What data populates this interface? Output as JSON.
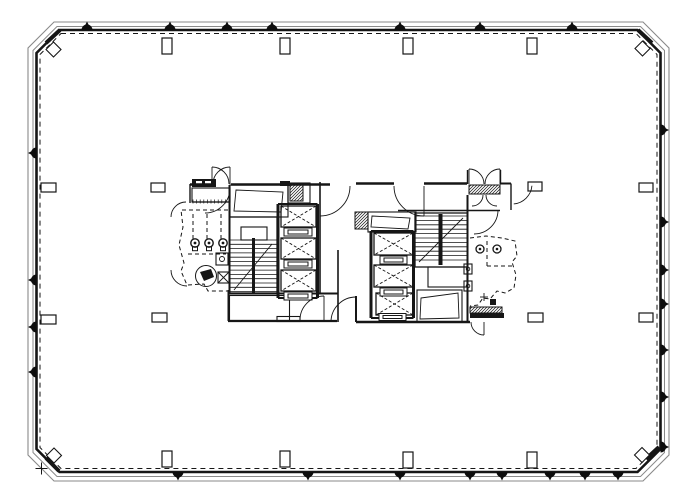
{
  "meta": {
    "drawing": "office-tower-typical-floor-plan",
    "canvas": {
      "w": 700,
      "h": 500
    },
    "colors": {
      "bg": "#ffffff",
      "ink": "#161616",
      "shell_gray": "#8a8a8a",
      "marker": "#0d0d0d"
    }
  },
  "shell": {
    "outer_poly": [
      [
        54,
        22
      ],
      [
        643,
        22
      ],
      [
        669,
        48
      ],
      [
        669,
        455
      ],
      [
        643,
        481
      ],
      [
        54,
        481
      ],
      [
        28,
        455
      ],
      [
        28,
        48
      ]
    ],
    "inner_poly": [
      [
        57,
        26.5
      ],
      [
        640.5,
        26.5
      ],
      [
        664.5,
        50.5
      ],
      [
        664.5,
        452.5
      ],
      [
        640.5,
        476.5
      ],
      [
        57,
        476.5
      ],
      [
        33,
        452.5
      ],
      [
        33,
        50.5
      ]
    ],
    "wall_poly": [
      [
        59.5,
        30
      ],
      [
        637.5,
        30
      ],
      [
        660.5,
        53
      ],
      [
        660.5,
        449
      ],
      [
        637.5,
        472
      ],
      [
        59.5,
        472
      ],
      [
        36.5,
        449
      ],
      [
        36.5,
        53
      ]
    ],
    "dash_poly": [
      [
        61,
        33.5
      ],
      [
        636,
        33.5
      ],
      [
        657,
        54.5
      ],
      [
        657,
        447.5
      ],
      [
        636,
        468.5
      ],
      [
        61,
        468.5
      ],
      [
        40,
        447.5
      ],
      [
        40,
        54.5
      ]
    ],
    "corner_wedges": [
      [
        46,
        43,
        60,
        30
      ],
      [
        638,
        30,
        652,
        43
      ],
      [
        46,
        458,
        59,
        471
      ],
      [
        646,
        459,
        659,
        447
      ]
    ],
    "diamonds": [
      {
        "cx": 53.5,
        "cy": 49.5
      },
      {
        "cx": 642.5,
        "cy": 48.5
      },
      {
        "cx": 54,
        "cy": 455.5
      },
      {
        "cx": 642,
        "cy": 455
      }
    ],
    "diamond_half": 7.5,
    "cross": {
      "x": 41.5,
      "y": 468.5,
      "arm": 6
    }
  },
  "perimeter_markers": {
    "r": 5.5,
    "top": {
      "y": 30,
      "xs": [
        87,
        170,
        227,
        272,
        400,
        480,
        572
      ]
    },
    "bottom": {
      "y": 472,
      "xs": [
        178,
        308,
        400,
        470,
        502,
        550,
        585,
        618
      ]
    },
    "left": {
      "x": 36.5,
      "ys": [
        153,
        280,
        327,
        372
      ]
    },
    "right": {
      "x": 660.5,
      "ys": [
        130,
        222,
        270,
        304,
        350,
        397,
        447
      ]
    }
  },
  "columns": [
    [
      162,
      38,
      10,
      16
    ],
    [
      280,
      38,
      10,
      16
    ],
    [
      403,
      38,
      10,
      16
    ],
    [
      527,
      38,
      10,
      16
    ],
    [
      162,
      451,
      10,
      16
    ],
    [
      280,
      451,
      10,
      16
    ],
    [
      403,
      452,
      10,
      16
    ],
    [
      527,
      452,
      10,
      16
    ],
    [
      41,
      183,
      15,
      9
    ],
    [
      41,
      315,
      15,
      9
    ],
    [
      639,
      183,
      14,
      9
    ],
    [
      639,
      313,
      14,
      9
    ],
    [
      151,
      183,
      14,
      9
    ],
    [
      528,
      182,
      14,
      9
    ],
    [
      152,
      313,
      15,
      9
    ],
    [
      528,
      313,
      15,
      9
    ]
  ],
  "core": {
    "walls": [
      [
        190,
        184.5,
        211,
        184.5,
        2.5
      ],
      [
        231,
        184.5,
        330,
        184.5,
        2.5
      ],
      [
        190,
        184,
        190,
        203,
        1.4
      ],
      [
        192,
        202,
        230,
        202,
        1.2
      ],
      [
        229.5,
        185,
        229.5,
        293,
        2
      ],
      [
        288,
        183,
        288,
        203,
        1.2
      ],
      [
        320,
        182,
        320,
        293,
        1.6
      ],
      [
        338,
        250,
        338,
        322,
        1.6
      ],
      [
        228,
        293.5,
        338,
        293.5,
        2
      ],
      [
        228.5,
        290,
        228.5,
        321,
        2
      ],
      [
        228,
        321,
        337,
        321,
        2.2
      ],
      [
        356,
        183.5,
        394,
        183.5,
        2.5
      ],
      [
        424,
        183.5,
        467,
        183.5,
        2.5
      ],
      [
        500,
        183.5,
        511,
        183.5,
        2
      ],
      [
        511,
        183.5,
        511,
        210,
        1.4
      ],
      [
        398,
        210.5,
        467,
        210.5,
        1.4
      ],
      [
        467.5,
        195,
        467.5,
        322,
        2
      ],
      [
        356,
        322,
        470,
        322,
        2.4
      ],
      [
        356,
        296,
        356,
        322,
        2
      ],
      [
        467.5,
        210.5,
        500,
        210.5,
        1.4
      ],
      [
        467.5,
        170,
        467.5,
        184,
        1.4
      ],
      [
        500.5,
        170,
        500.5,
        184,
        1.4
      ],
      [
        278,
        204,
        278,
        298,
        3
      ],
      [
        317.5,
        204,
        317.5,
        298,
        3
      ],
      [
        278,
        204,
        317.5,
        204,
        2
      ],
      [
        278,
        298,
        317.5,
        298,
        2
      ],
      [
        371,
        231,
        371,
        318,
        3
      ],
      [
        413.5,
        231,
        413.5,
        318,
        3
      ],
      [
        371,
        231,
        413.5,
        231,
        2
      ],
      [
        371,
        318,
        413.5,
        318,
        2
      ]
    ],
    "rooms": [
      [
        192,
        188,
        38,
        14
      ],
      [
        230,
        185,
        58,
        32
      ],
      [
        288,
        183,
        22,
        20
      ],
      [
        368,
        212,
        48,
        20
      ],
      [
        417,
        290,
        45,
        32
      ],
      [
        428,
        267,
        39,
        20
      ],
      [
        241,
        227,
        26,
        13
      ],
      [
        229.5,
        295.5,
        60,
        25
      ],
      [
        277,
        316.5,
        23,
        5
      ],
      [
        216,
        253,
        12,
        12
      ],
      [
        464,
        264,
        8,
        10
      ],
      [
        464,
        281,
        8,
        10
      ],
      [
        218,
        272,
        11,
        11
      ]
    ],
    "quads": [
      [
        [
          236,
          190
        ],
        [
          283,
          192
        ],
        [
          281,
          212
        ],
        [
          234,
          211
        ]
      ],
      [
        [
          372,
          216
        ],
        [
          410,
          218
        ],
        [
          408,
          229
        ],
        [
          371,
          227
        ]
      ],
      [
        [
          421,
          298
        ],
        [
          458,
          293
        ],
        [
          459,
          318
        ],
        [
          420,
          319
        ]
      ]
    ],
    "hatches": [
      [
        290,
        185,
        13,
        16
      ],
      [
        355,
        212,
        13,
        17
      ],
      [
        469,
        185,
        31,
        9
      ],
      [
        470,
        307,
        32,
        6
      ]
    ],
    "solids": [
      [
        192,
        179,
        24,
        8
      ],
      [
        280,
        181,
        10,
        5
      ],
      [
        470,
        313,
        34,
        5
      ],
      [
        490,
        299,
        6,
        6
      ],
      [
        252,
        238,
        3,
        55
      ],
      [
        438.5,
        214,
        4,
        51
      ]
    ],
    "whites": [
      [
        196,
        181,
        6,
        4
      ],
      [
        205,
        181,
        6,
        4
      ]
    ],
    "elevators": [
      [
        281,
        206,
        35,
        21
      ],
      [
        281,
        238,
        35,
        21
      ],
      [
        281,
        270,
        35,
        21
      ],
      [
        374,
        233,
        39,
        22
      ],
      [
        374,
        265,
        39,
        22
      ],
      [
        376,
        293,
        37,
        22
      ]
    ],
    "sills": [
      [
        284,
        228,
        28,
        8
      ],
      [
        284,
        260,
        28,
        8
      ],
      [
        284,
        292,
        28,
        8
      ],
      [
        380,
        256,
        27,
        8
      ],
      [
        380,
        288,
        27,
        8
      ],
      [
        379,
        313.5,
        27,
        7
      ]
    ],
    "stairs": [
      {
        "x": 229.5,
        "y": 217,
        "w": 47.5,
        "h": 76,
        "t0": 240,
        "t1": 292,
        "step": 4.3,
        "div": 253.5
      },
      {
        "x": 415,
        "y": 213,
        "w": 52.5,
        "h": 54,
        "t0": 216,
        "t1": 264,
        "step": 4.4,
        "div": 440.5
      }
    ],
    "dashed_polys": [
      [
        [
          228,
          210
        ],
        [
          181,
          210
        ],
        [
          183,
          227
        ],
        [
          179,
          245
        ],
        [
          184,
          263
        ],
        [
          181,
          271
        ],
        [
          187,
          285
        ],
        [
          204,
          284
        ],
        [
          208,
          291
        ],
        [
          228,
          291
        ]
      ],
      [
        [
          470,
          238
        ],
        [
          486,
          236
        ],
        [
          502,
          238
        ],
        [
          515,
          241
        ],
        [
          517,
          256
        ],
        [
          512,
          262
        ],
        [
          516,
          275
        ],
        [
          514,
          288
        ],
        [
          505,
          293
        ],
        [
          497,
          291
        ],
        [
          490,
          299
        ],
        [
          483,
          298
        ],
        [
          478,
          305
        ],
        [
          470,
          306
        ]
      ],
      [
        [
          193,
          214
        ],
        [
          193,
          240
        ]
      ],
      [
        [
          207,
          214
        ],
        [
          207,
          240
        ]
      ],
      [
        [
          221,
          214
        ],
        [
          221,
          240
        ]
      ],
      [
        [
          188,
          254
        ],
        [
          226,
          254
        ]
      ],
      [
        [
          487,
          241
        ],
        [
          487,
          266
        ]
      ],
      [
        [
          487,
          266
        ],
        [
          513,
          266
        ]
      ]
    ],
    "door_arcs": [
      {
        "cx": 212,
        "cy": 184,
        "r": 17,
        "a0": 270,
        "a1": 360
      },
      {
        "cx": 230,
        "cy": 184,
        "r": 17,
        "a0": 180,
        "a1": 270
      },
      {
        "cx": 320,
        "cy": 186,
        "r": 30,
        "a0": 0,
        "a1": 90
      },
      {
        "cx": 424,
        "cy": 186,
        "r": 30,
        "a0": 90,
        "a1": 180
      },
      {
        "cx": 186,
        "cy": 217,
        "r": 15,
        "a0": 180,
        "a1": 270
      },
      {
        "cx": 187,
        "cy": 270,
        "r": 16,
        "a0": 90,
        "a1": 180
      },
      {
        "cx": 324,
        "cy": 320,
        "r": 24,
        "a0": 180,
        "a1": 270
      },
      {
        "cx": 356,
        "cy": 322,
        "r": 25,
        "a0": 180,
        "a1": 270
      },
      {
        "cx": 474,
        "cy": 210,
        "r": 24,
        "a0": 0,
        "a1": 90
      },
      {
        "cx": 484,
        "cy": 322,
        "r": 13,
        "a0": 90,
        "a1": 180
      },
      {
        "cx": 469,
        "cy": 184,
        "r": 15,
        "a0": 270,
        "a1": 360
      },
      {
        "cx": 500,
        "cy": 184,
        "r": 15,
        "a0": 180,
        "a1": 270
      },
      {
        "cx": 472,
        "cy": 195,
        "r": 11,
        "a0": 0,
        "a1": 90
      },
      {
        "cx": 497,
        "cy": 195,
        "r": 11,
        "a0": 90,
        "a1": 180
      },
      {
        "cx": 512,
        "cy": 184,
        "r": 20,
        "a0": 5,
        "a1": 85
      },
      {
        "cx": 205,
        "cy": 188,
        "r": 25,
        "a0": 0,
        "a1": 90
      }
    ],
    "thin_lines": [
      [
        212,
        184,
        212,
        167
      ],
      [
        230,
        184,
        230,
        167
      ],
      [
        424,
        186,
        424,
        216
      ],
      [
        324,
        320,
        324,
        296
      ],
      [
        484,
        322,
        484,
        335
      ],
      [
        469,
        184,
        469,
        169
      ],
      [
        500,
        184,
        500,
        169
      ],
      [
        218,
        272,
        229,
        283
      ],
      [
        229,
        272,
        218,
        283
      ],
      [
        234,
        290,
        272,
        244
      ],
      [
        419,
        262,
        463,
        218
      ],
      [
        480,
        297,
        488,
        297
      ],
      [
        484,
        293,
        484,
        301
      ]
    ],
    "ticks": [
      {
        "x1": 193,
        "x2": 229,
        "y": 201.5,
        "step": 3.6,
        "h": 4
      }
    ],
    "fixtures": {
      "toilets": [
        [
          195,
          243
        ],
        [
          209,
          243
        ],
        [
          223,
          243
        ]
      ],
      "toilet_r": 4.2,
      "wc_pair": [
        [
          480,
          249
        ],
        [
          497,
          249
        ]
      ],
      "wc_r": 4,
      "wheelchair": {
        "cx": 206,
        "cy": 276,
        "r": 10.5,
        "body": [
          [
            200,
            272
          ],
          [
            211,
            269
          ],
          [
            214,
            277
          ],
          [
            204,
            281
          ]
        ]
      },
      "sink_dots": [
        [
          222,
          259,
          2.5
        ],
        [
          468,
          269,
          1.8
        ],
        [
          468,
          286,
          1.8
        ]
      ]
    }
  }
}
